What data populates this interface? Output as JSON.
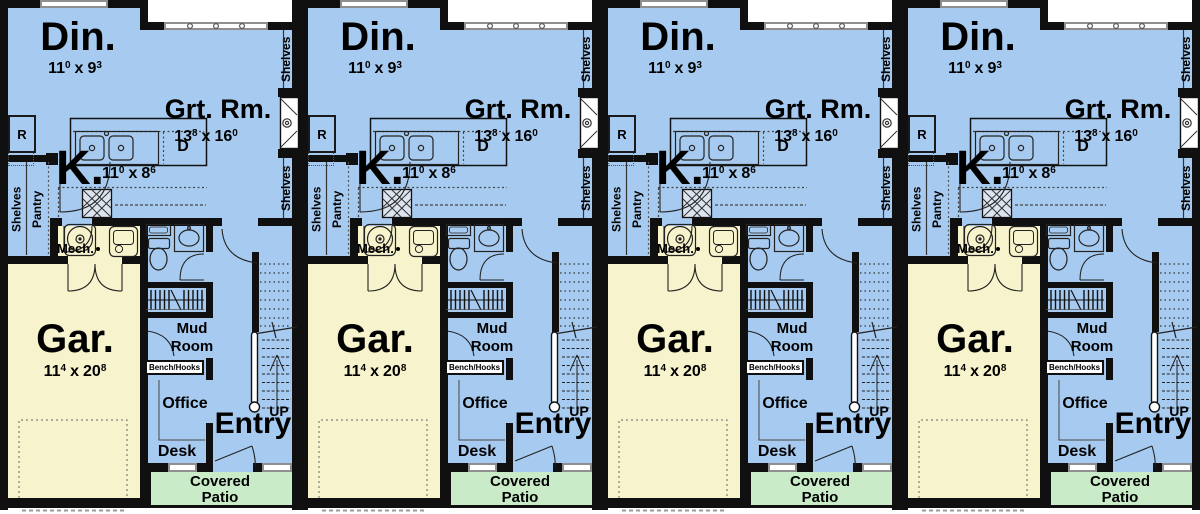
{
  "title": "Four-unit multiplex first-floor plan",
  "units_count": 4,
  "copyright": "©",
  "colors": {
    "floor_blue": "#a7cbf0",
    "garage_yellow": "#f7f3cc",
    "patio_green": "#c9ebc8",
    "wall_black": "#101010",
    "window_gray": "#8f8f8f"
  },
  "unit": {
    "dining": {
      "label": "Din.",
      "dim": {
        "a": "11",
        "as": "0",
        "sep": "x",
        "b": "9",
        "bs": "3"
      }
    },
    "great_room": {
      "label": "Grt. Rm.",
      "dim": {
        "a": "13",
        "as": "8",
        "sep": "x",
        "b": "16",
        "bs": "0"
      }
    },
    "kitchen": {
      "label": "K.",
      "dim": {
        "a": "11",
        "as": "0",
        "sep": "x",
        "b": "8",
        "bs": "6"
      }
    },
    "garage": {
      "label": "Gar.",
      "dim": {
        "a": "11",
        "as": "4",
        "sep": "x",
        "b": "20",
        "bs": "8"
      }
    },
    "mech": {
      "label": "Mech."
    },
    "mud_room": {
      "line1": "Mud",
      "line2": "Room"
    },
    "bench_hooks": {
      "label": "Bench/Hooks"
    },
    "office": {
      "label": "Office"
    },
    "desk": {
      "label": "Desk"
    },
    "entry": {
      "label": "Entry"
    },
    "stairs": {
      "label": "UP"
    },
    "covered_patio": {
      "line1": "Covered",
      "line2": "Patio"
    },
    "pantry": {
      "label": "Pantry"
    },
    "shelves": {
      "label": "Shelves"
    },
    "appliances": {
      "refrigerator": "R",
      "dishwasher": "D"
    }
  }
}
